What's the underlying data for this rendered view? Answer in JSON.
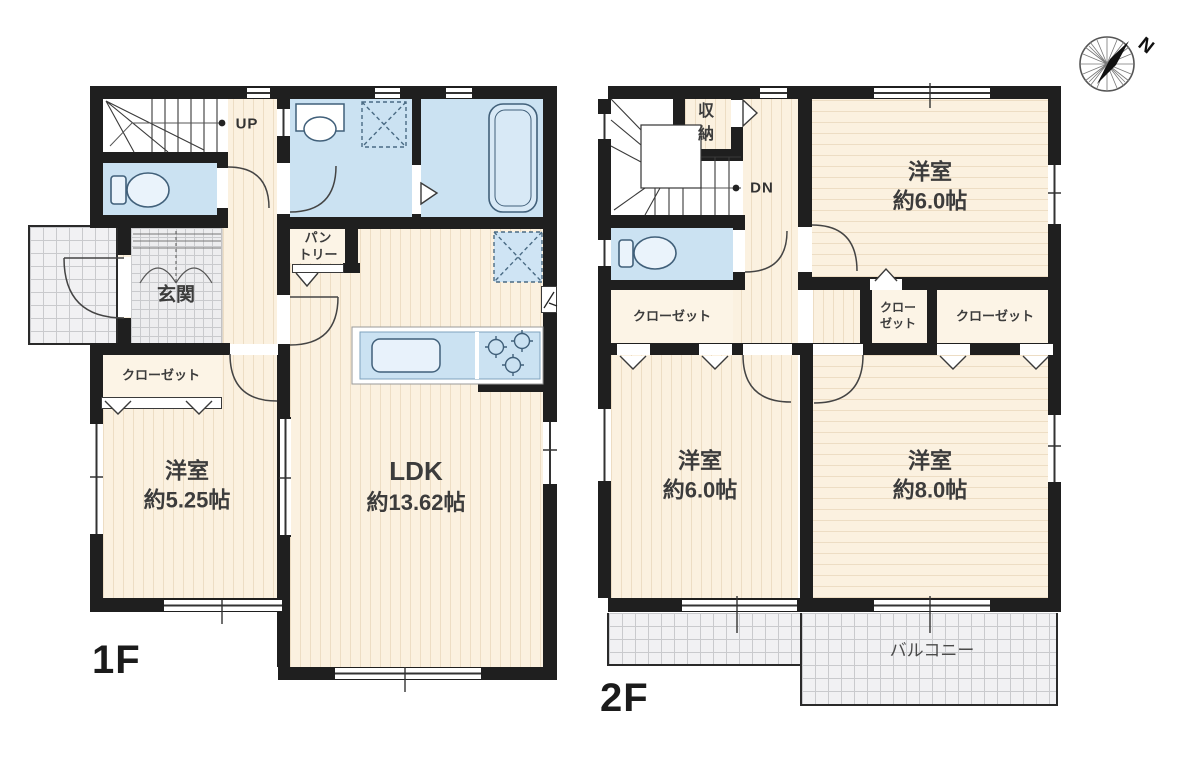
{
  "title": "2-story house floor plan",
  "compass": {
    "label": "N"
  },
  "colors": {
    "wall": "#1f1f1f",
    "room_cream": "#fbf1e0",
    "wet_area_blue": "#cbe2f2",
    "grid_gray": "#f1f1f3",
    "line": "#3a3a3a"
  },
  "floor1": {
    "floor_label": "1F",
    "stairs_direction": "UP",
    "entrance_label": "玄関",
    "closet_label": "クローゼット",
    "pantry_line1": "パン",
    "pantry_line2": "トリー",
    "western_room": {
      "name": "洋室",
      "size": "約5.25帖"
    },
    "ldk": {
      "name": "LDK",
      "size": "約13.62帖"
    }
  },
  "floor2": {
    "floor_label": "2F",
    "stairs_direction": "DN",
    "storage_line1": "収",
    "storage_line2": "納",
    "closet_left_label": "クローゼット",
    "closet_mid_line1": "クロー",
    "closet_mid_line2": "ゼット",
    "closet_right_label": "クローゼット",
    "bedroom_ne": {
      "name": "洋室",
      "size": "約6.0帖"
    },
    "bedroom_sw": {
      "name": "洋室",
      "size": "約6.0帖"
    },
    "bedroom_se": {
      "name": "洋室",
      "size": "約8.0帖"
    },
    "balcony_label": "バルコニー"
  }
}
